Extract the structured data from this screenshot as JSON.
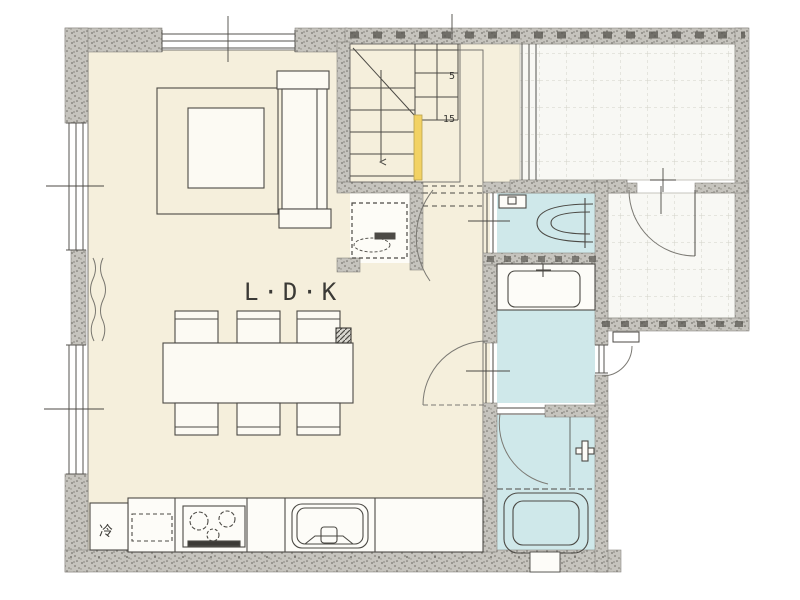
{
  "meta": {
    "description": "Hand-drawn first-floor plan of a Japanese house (LDK, stairs, toilet, washroom, bathroom, tiled entrance and terrace)"
  },
  "labels": {
    "room_ldk": "L·D·K",
    "refrigerator": "冷",
    "stair_count_upper": "5",
    "stair_count_lower": "15"
  },
  "rooms": [
    {
      "id": "ldk",
      "label": "L·D·K",
      "floor": "cream"
    },
    {
      "id": "stairs",
      "floor": "cream"
    },
    {
      "id": "under-stair-storage",
      "floor": "white"
    },
    {
      "id": "hall",
      "floor": "cream"
    },
    {
      "id": "toilet",
      "floor": "blue"
    },
    {
      "id": "washroom",
      "floor": "blue"
    },
    {
      "id": "bathroom",
      "floor": "blue"
    },
    {
      "id": "entrance-genkan",
      "floor": "tile"
    },
    {
      "id": "terrace",
      "floor": "tile"
    }
  ],
  "colors": {
    "floor_cream": "#f5efdc",
    "floor_wet_blue": "#cfe8ea",
    "tile_white": "#f8f8f4",
    "wall_gray": "#c6c4be",
    "stair_handrail_yellow": "#f2d264",
    "line_dark": "#4c4a45",
    "background": "#ffffff"
  }
}
